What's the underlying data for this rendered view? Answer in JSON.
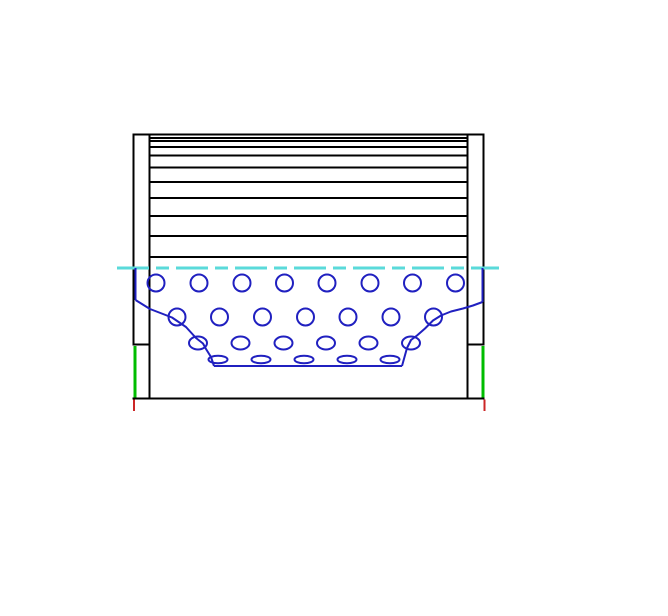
{
  "canvas": {
    "width": 668,
    "height": 616,
    "background": "#ffffff"
  },
  "palette": {
    "outline_black": "#000000",
    "perforation_blue": "#2020c0",
    "centerline_cyan": "#5adada",
    "seal_green": "#00bd00",
    "datum_red": "#cc2626"
  },
  "strokes": {
    "outline": 2,
    "pleat": 2,
    "perforation": 2,
    "centerline": 3,
    "seal": 3,
    "datum": 2
  },
  "drawing": {
    "outline_lines": [
      {
        "name": "left-cap-outer-edge",
        "x1": 133.5,
        "y1": 134.5,
        "x2": 133.5,
        "y2": 345
      },
      {
        "name": "left-cap-inner-edge",
        "x1": 149.5,
        "y1": 134.5,
        "x2": 149.5,
        "y2": 398.5
      },
      {
        "name": "left-cap-top-edge",
        "x1": 132.5,
        "y1": 134.5,
        "x2": 150.5,
        "y2": 134.5
      },
      {
        "name": "left-cap-divider",
        "x1": 132.5,
        "y1": 344.5,
        "x2": 150.5,
        "y2": 344.5
      },
      {
        "name": "right-cap-outer-edge",
        "x1": 483.5,
        "y1": 134.5,
        "x2": 483.5,
        "y2": 345
      },
      {
        "name": "right-cap-inner-edge",
        "x1": 467.5,
        "y1": 134.5,
        "x2": 467.5,
        "y2": 398.5
      },
      {
        "name": "right-cap-top-edge",
        "x1": 466.5,
        "y1": 134.5,
        "x2": 484.5,
        "y2": 134.5
      },
      {
        "name": "right-cap-divider",
        "x1": 466.5,
        "y1": 344.5,
        "x2": 484.5,
        "y2": 344.5
      },
      {
        "name": "bottom-edge",
        "x1": 132.5,
        "y1": 398.5,
        "x2": 484.5,
        "y2": 398.5
      }
    ],
    "pleats": {
      "x1": 149.5,
      "x2": 467.5,
      "ys": [
        134.5,
        138,
        141,
        147,
        155.5,
        167.5,
        182,
        198,
        216,
        236,
        257
      ]
    },
    "centerline": {
      "y": 268,
      "x1": 117,
      "x2": 499,
      "dash": "32 7 13 7"
    },
    "seal_lines": [
      {
        "name": "seal-line-left",
        "x": 135,
        "y1": 346,
        "y2": 397.5
      },
      {
        "name": "seal-line-right",
        "x": 483,
        "y1": 346,
        "y2": 397.5
      }
    ],
    "datum_ticks": [
      {
        "name": "datum-tick-left",
        "x": 134,
        "y1": 399.5,
        "y2": 411
      },
      {
        "name": "datum-tick-right",
        "x": 484.5,
        "y1": 399.5,
        "y2": 411
      }
    ],
    "core_section": {
      "edges": [
        {
          "name": "section-left-edge",
          "x": 135.5,
          "y1": 268,
          "y2": 300
        },
        {
          "name": "section-right-edge",
          "x": 482.5,
          "y1": 268,
          "y2": 302
        }
      ],
      "left_break": "135.5,300 150,309 163,314 172,317.5 186,327 196,338 203,343.5 206,349 211,357 214,366",
      "right_break": "402,366 404.5,357 407,348 411,340 417,335.5 425,328.5 433,320.5 441,315.5 451,311.5 463,308.5 473,305.5 482.5,302",
      "bottom_line": {
        "y": 366,
        "x1": 214,
        "x2": 402
      },
      "hole_rows": [
        {
          "y": 283,
          "rx": 8.5,
          "ry": 8.5,
          "xs": [
            156,
            199,
            242,
            284.5,
            327,
            370,
            412.5,
            455.5
          ]
        },
        {
          "y": 317,
          "rx": 8.5,
          "ry": 8.5,
          "xs": [
            177,
            219.5,
            262.5,
            305.5,
            348,
            391,
            433.5
          ]
        },
        {
          "y": 343,
          "rx": 9,
          "ry": 6.5,
          "xs": [
            198,
            240.5,
            283.5,
            326,
            368.5,
            411
          ]
        },
        {
          "y": 359.5,
          "rx": 9.5,
          "ry": 3.8,
          "xs": [
            218,
            261,
            304,
            347,
            390
          ]
        }
      ]
    }
  }
}
